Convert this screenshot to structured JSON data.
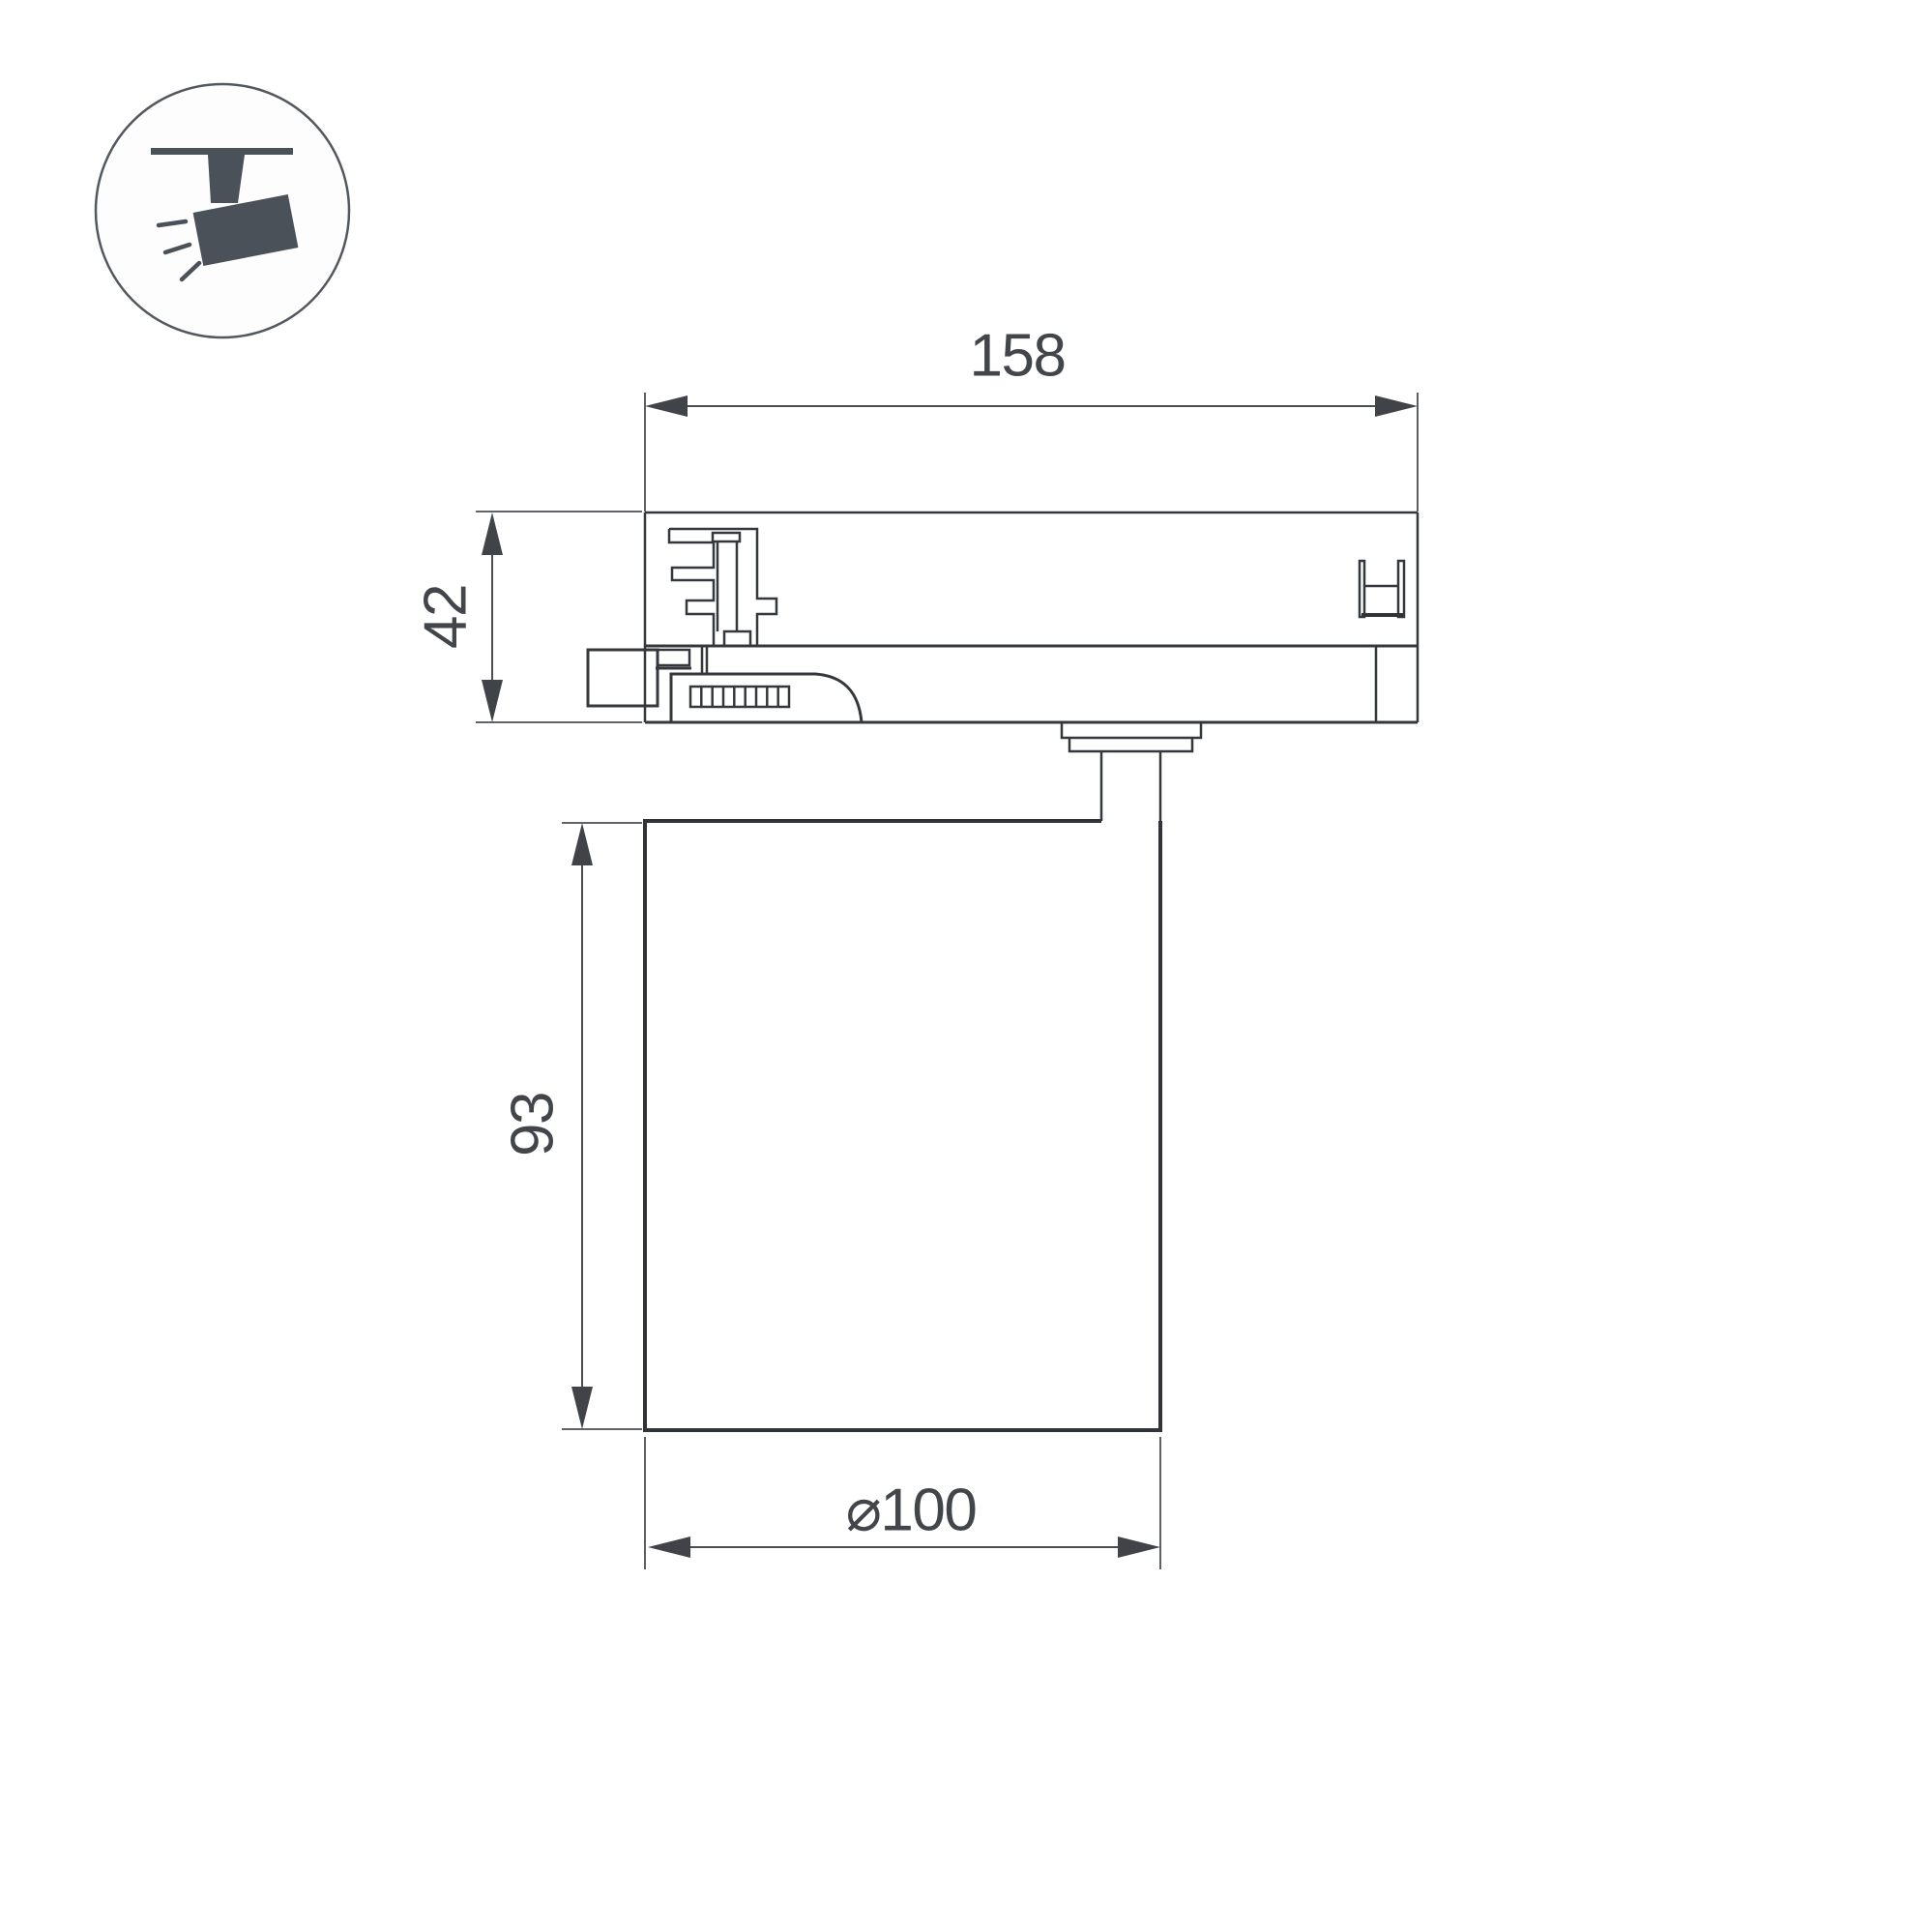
{
  "icon": {
    "name": "track-spotlight-icon",
    "description": "circled pictogram of a spotlight hanging from a ceiling track"
  },
  "dimensions": {
    "track_width_label": "158",
    "adapter_height_label": "42",
    "body_height_label": "93",
    "body_diameter_label": "⌀100"
  },
  "colors": {
    "background": "#ffffff",
    "outline": "#34383d",
    "dimension_lines": "#4a4e53",
    "dimension_text": "#42464b",
    "icon": "#4b5158"
  }
}
